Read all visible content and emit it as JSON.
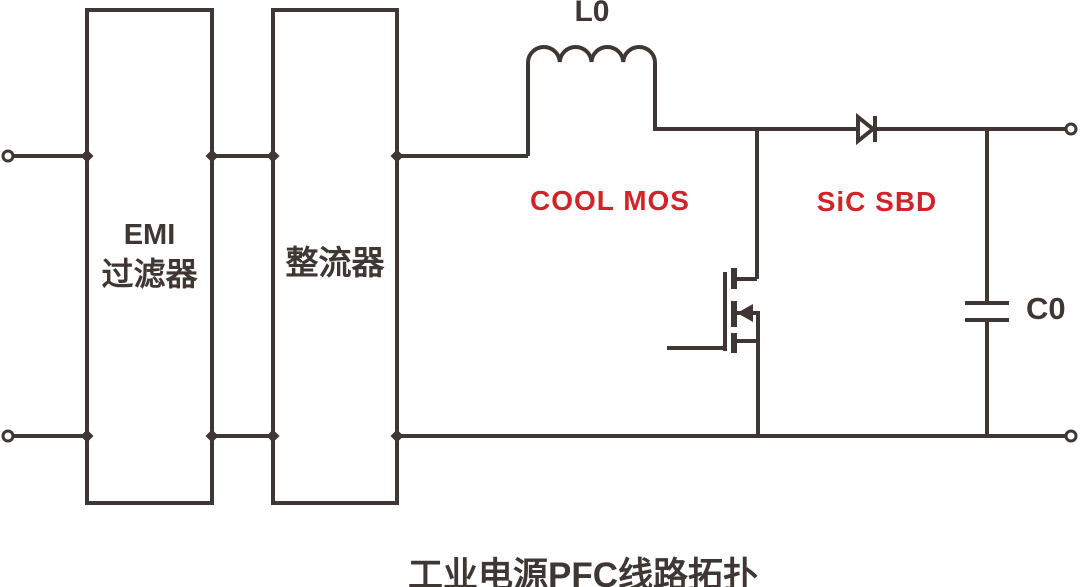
{
  "diagram": {
    "title": "工业电源PFC线路拓扑",
    "blocks": {
      "emi_filter_line1": "EMI",
      "emi_filter_line2": "过滤器",
      "rectifier": "整流器"
    },
    "components": {
      "inductor_label": "L0",
      "mosfet_label": "COOL MOS",
      "diode_label": "SiC SBD",
      "capacitor_label": "C0"
    },
    "colors": {
      "line": "#3F3733",
      "highlight_red": "#D2232A",
      "background": "#FFFFFF"
    }
  }
}
